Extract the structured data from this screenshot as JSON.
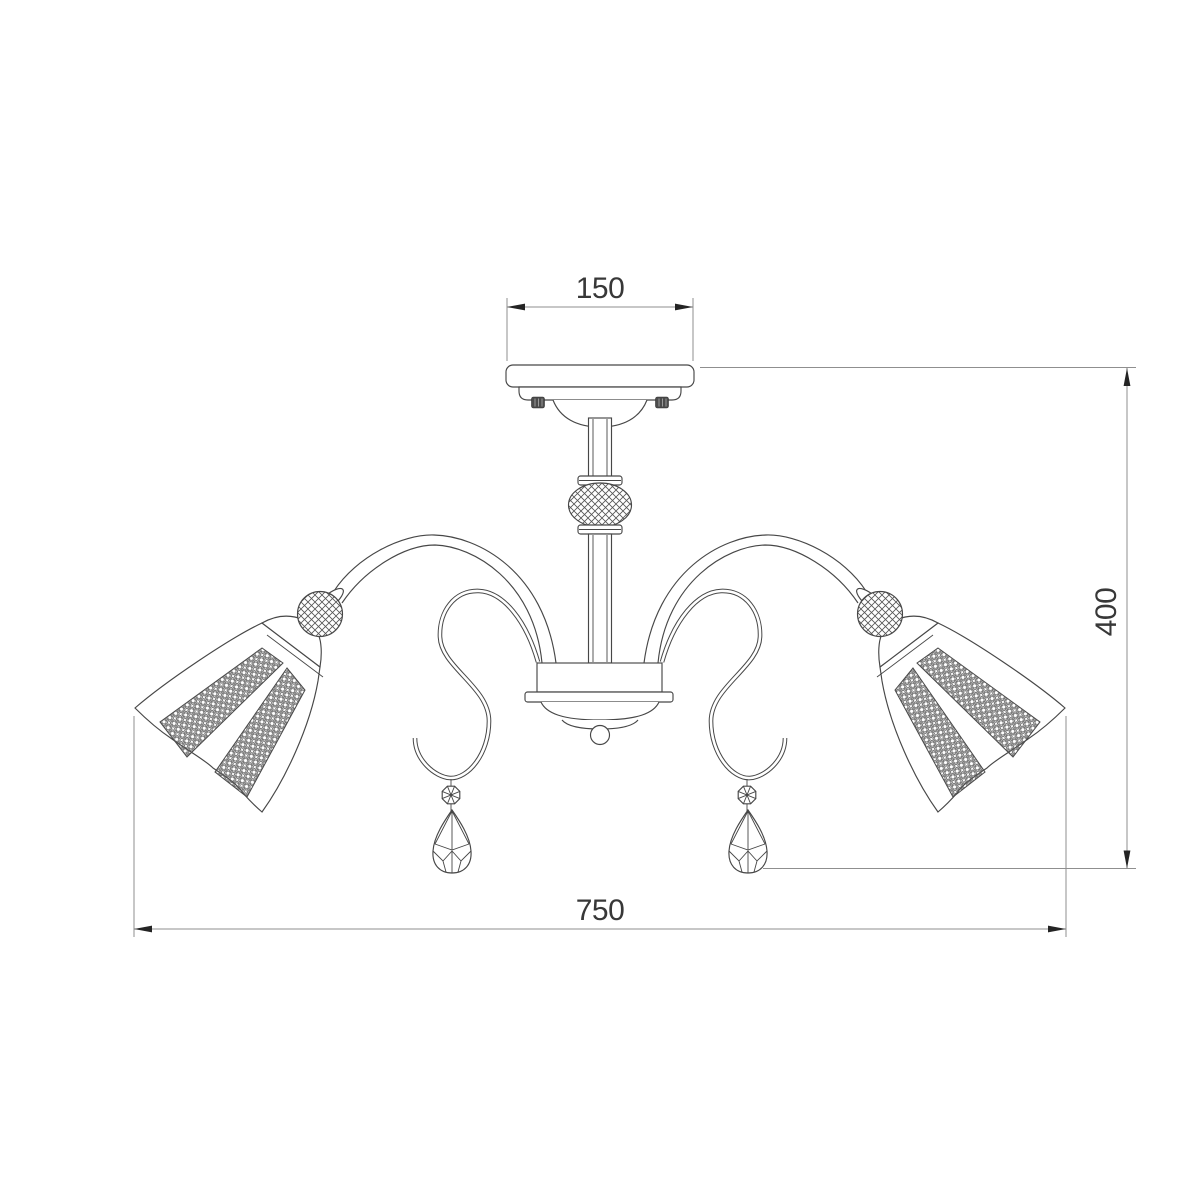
{
  "document": {
    "kind": "technical-dimension-drawing",
    "subject": "three-arm ceiling chandelier, front elevation",
    "background_color": "#ffffff"
  },
  "colors": {
    "line": "#474747",
    "dimension_line": "#8f8f8f",
    "text": "#383838",
    "arrow": "#242424"
  },
  "dimensions": {
    "canopy_width": "150",
    "fixture_height": "400",
    "fixture_width": "750"
  },
  "parts": [
    "ceiling-plate",
    "mounting-screws",
    "canopy-dome",
    "center-stem",
    "faceted-crystal-sphere",
    "central-hub",
    "finial-ball",
    "left-curved-arm",
    "right-curved-arm",
    "left-bell-shade",
    "right-bell-shade",
    "beaded-crystal-panels",
    "left-s-scroll",
    "right-s-scroll",
    "crystal-bead",
    "teardrop-crystal-pendant"
  ]
}
